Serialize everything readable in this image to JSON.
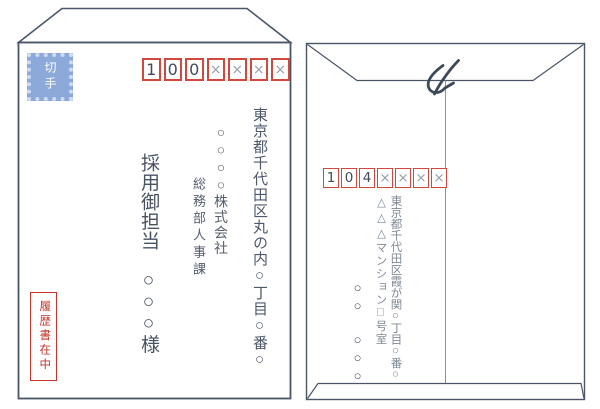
{
  "diagram_title": "envelope-addressing-example",
  "colors": {
    "outline": "#4a5568",
    "accent_red": "#d2473e",
    "enclosure_red": "#c5342c",
    "stamp_blue": "#8ca9da",
    "text_dark": "#4d586b",
    "text_gray": "#7f8997"
  },
  "left_envelope": {
    "side": "front",
    "stamp_label": "切手",
    "postal_code": [
      "1",
      "0",
      "0",
      "×",
      "×",
      "×",
      "×"
    ],
    "address": "東京都千代田区丸の内○丁目○番○",
    "company": "○○○○株式会社",
    "department": "総務部人事課",
    "recipient": "採用御担当　○○○様",
    "enclosure_note": "履歴書在中"
  },
  "right_envelope": {
    "side": "back",
    "seal_mark": "〆",
    "postal_code": [
      "1",
      "0",
      "4",
      "×",
      "×",
      "×",
      "×"
    ],
    "address": "東京都千代田区霞が関○丁目○番○",
    "address2": "△△△マンション□号室",
    "sender_name": "○○　○○○"
  }
}
